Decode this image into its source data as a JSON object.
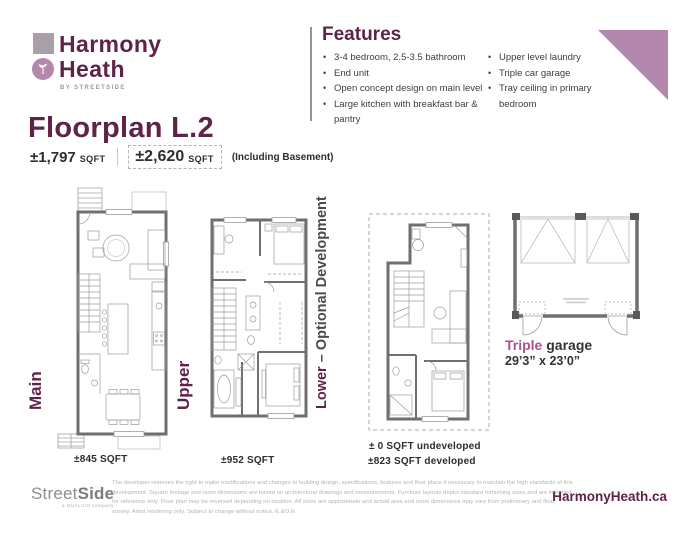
{
  "brand": {
    "name_line1": "Harmony",
    "name_line2": "Heath",
    "tagline": "BY STREETSIDE"
  },
  "features": {
    "title": "Features",
    "col1": [
      "3-4 bedroom, 2.5-3.5 bathroom",
      "End unit",
      "Open concept design on main level",
      "Large kitchen with breakfast bar & pantry"
    ],
    "col2": [
      "Upper level laundry",
      "Triple car garage",
      "Tray ceiling in primary bedroom"
    ]
  },
  "floorplan": {
    "title": "Floorplan L.2",
    "sqft_value": "±1,797",
    "sqft_unit": "SQFT",
    "total_value": "±2,620",
    "total_unit": "SQFT",
    "total_note": "(Including Basement)"
  },
  "floors": {
    "main": {
      "label": "Main",
      "sqft": "±845 SQFT"
    },
    "upper": {
      "label": "Upper",
      "sqft": "±952 SQFT"
    },
    "lower": {
      "label_accent": "Lower",
      "label_rest": " – Optional Development",
      "sqft_line1": "± 0 SQFT undeveloped",
      "sqft_line2": "±823 SQFT developed"
    },
    "garage": {
      "label_accent": "Triple",
      "label_rest": " garage",
      "dimensions": "29’3” x 23’0”"
    }
  },
  "footer": {
    "logo_regular": "Street",
    "logo_bold": "Side",
    "logo_tagline": "a QUALICO company",
    "disclaimer": "The developer reserves the right to make modifications and changes to building design, specifications, features and floor plans if necessary to maintain the high standards of this development. Square footage and room dimensions are based on architectural drawings and measurements. Furniture layouts depict standard furnishing sizes and are intended for reference only. Floor plan may be reversed depending on location. All sizes are approximate and actual area and room dimensions may vary from preliminary and final survey. Artist rendering only. Subject to change without notice. E.&O.E.",
    "website": "HarmonyHeath.ca"
  },
  "colors": {
    "brand_purple": "#5f2349",
    "accent_mauve": "#b388ac",
    "accent_pink": "#ab5190",
    "wall_gray": "#6f6f6f"
  }
}
